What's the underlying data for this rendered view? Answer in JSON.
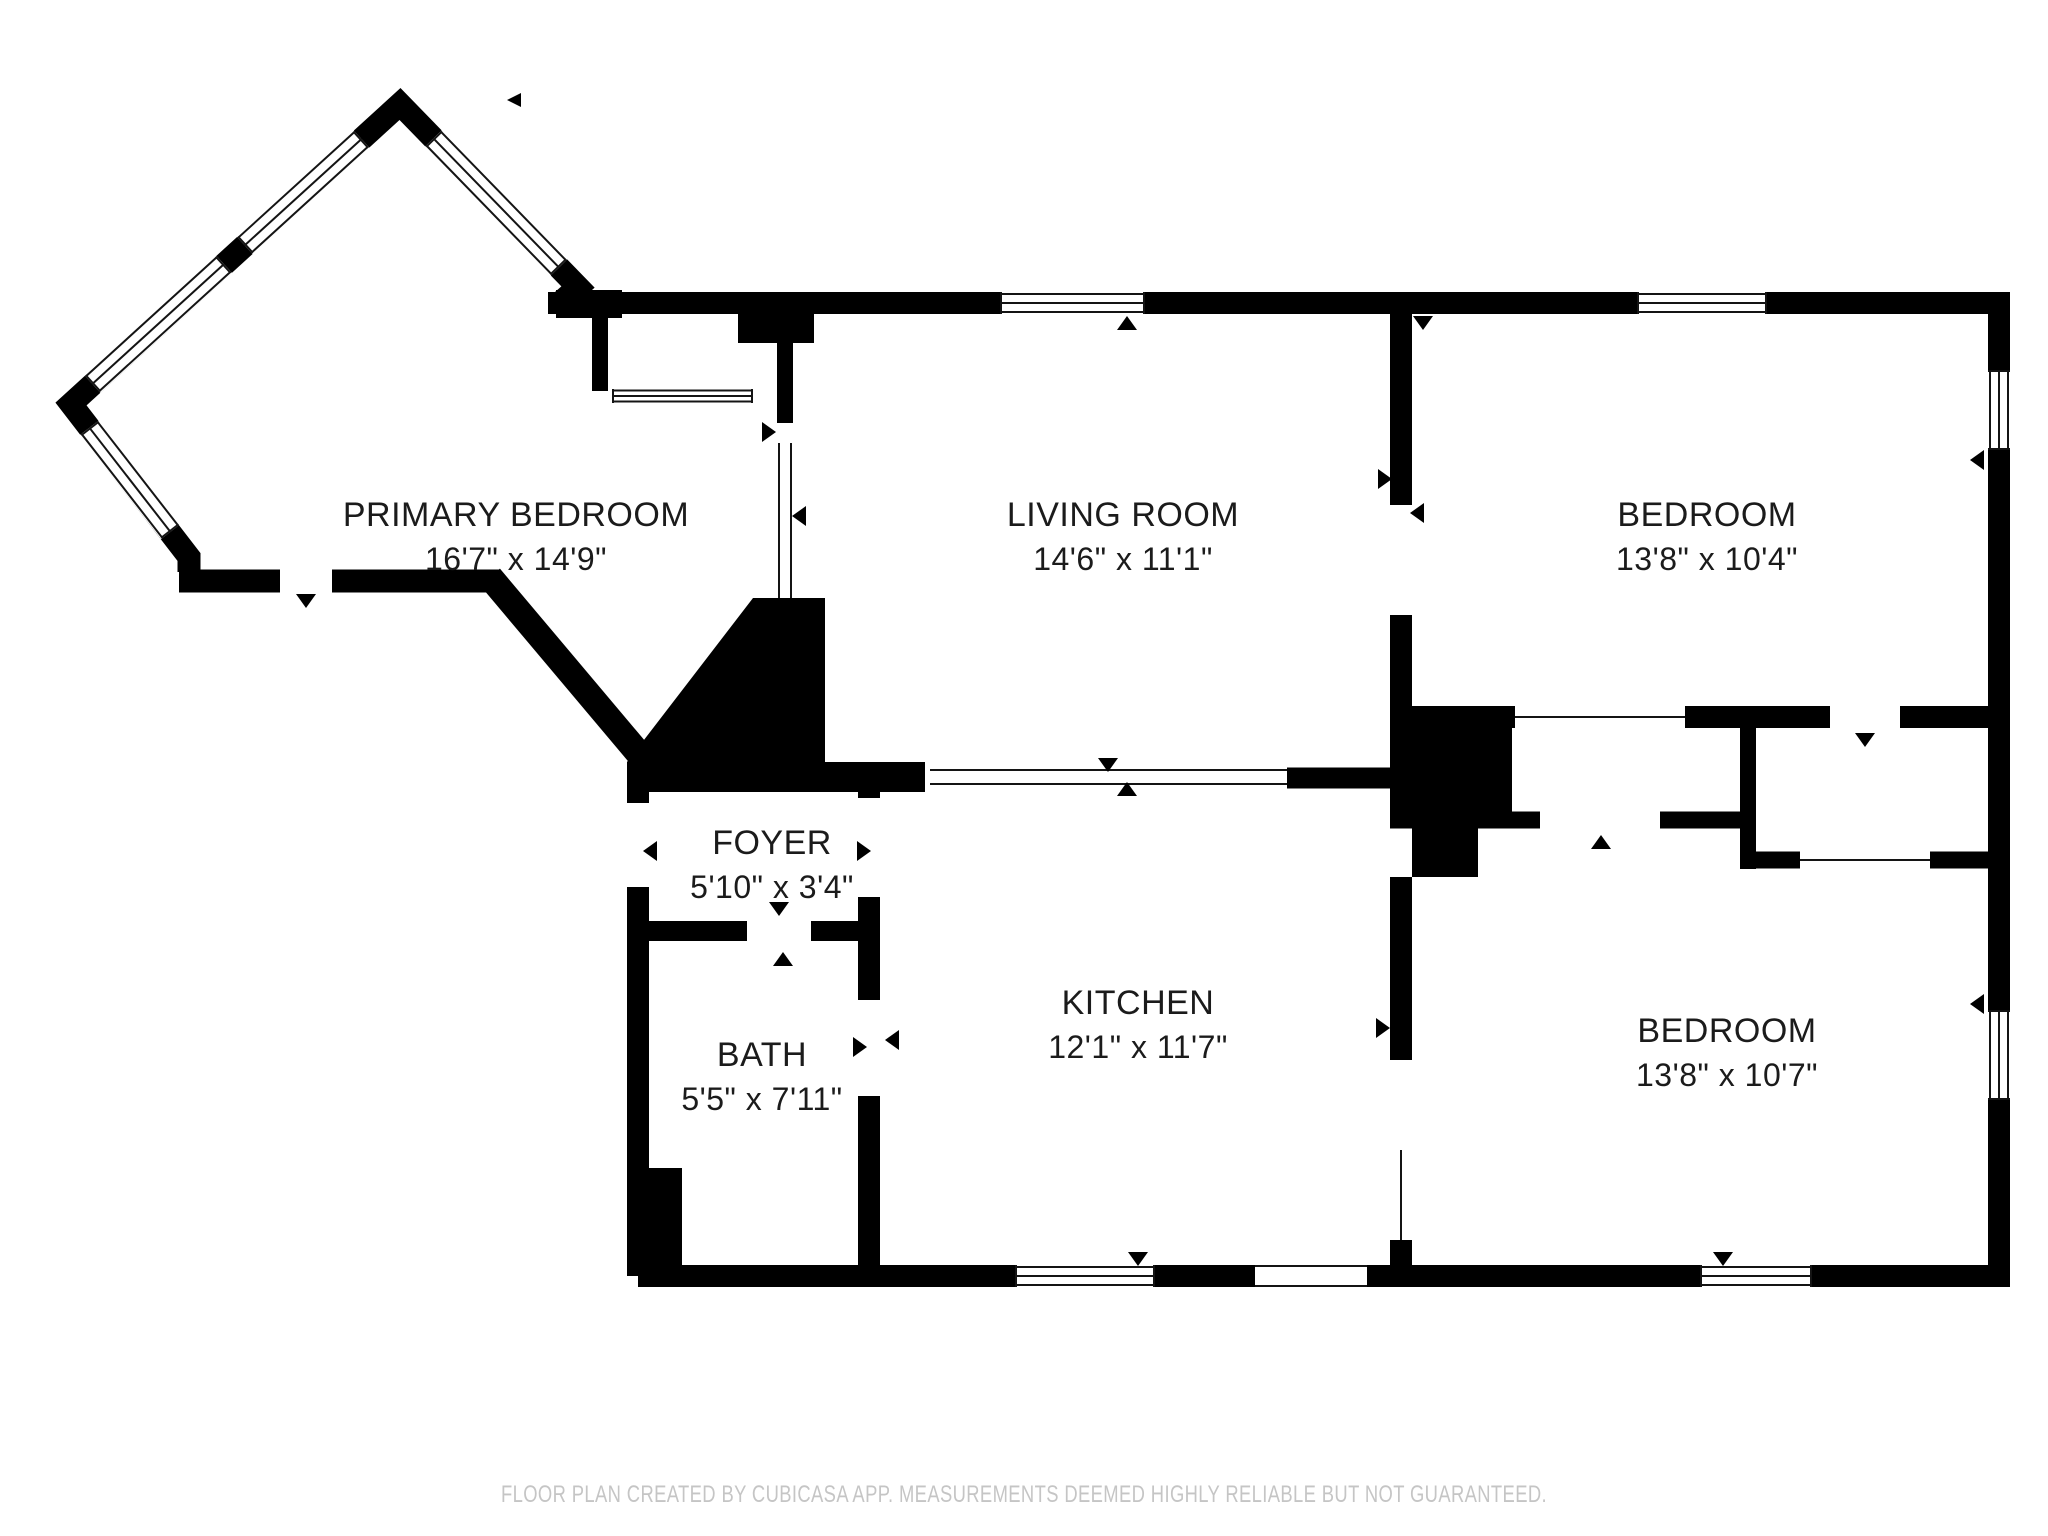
{
  "floor_plan": {
    "rooms": [
      {
        "id": "primary-bedroom",
        "name": "PRIMARY BEDROOM",
        "dimensions": "16'7\" x 14'9\""
      },
      {
        "id": "living-room",
        "name": "LIVING ROOM",
        "dimensions": "14'6\" x 11'1\""
      },
      {
        "id": "bedroom-top",
        "name": "BEDROOM",
        "dimensions": "13'8\" x 10'4\""
      },
      {
        "id": "foyer",
        "name": "FOYER",
        "dimensions": "5'10\" x 3'4\""
      },
      {
        "id": "bath",
        "name": "BATH",
        "dimensions": "5'5\" x 7'11\""
      },
      {
        "id": "kitchen",
        "name": "KITCHEN",
        "dimensions": "12'1\" x 11'7\""
      },
      {
        "id": "bedroom-bottom",
        "name": "BEDROOM",
        "dimensions": "13'8\" x 10'7\""
      }
    ],
    "footer": "FLOOR PLAN CREATED BY CUBICASA APP. MEASUREMENTS DEEMED HIGHLY RELIABLE BUT NOT GUARANTEED.",
    "colors": {
      "wall": "#000000",
      "background": "#ffffff",
      "room_label": "#1b1b1b",
      "footer_text": "#c5c5c5"
    }
  }
}
